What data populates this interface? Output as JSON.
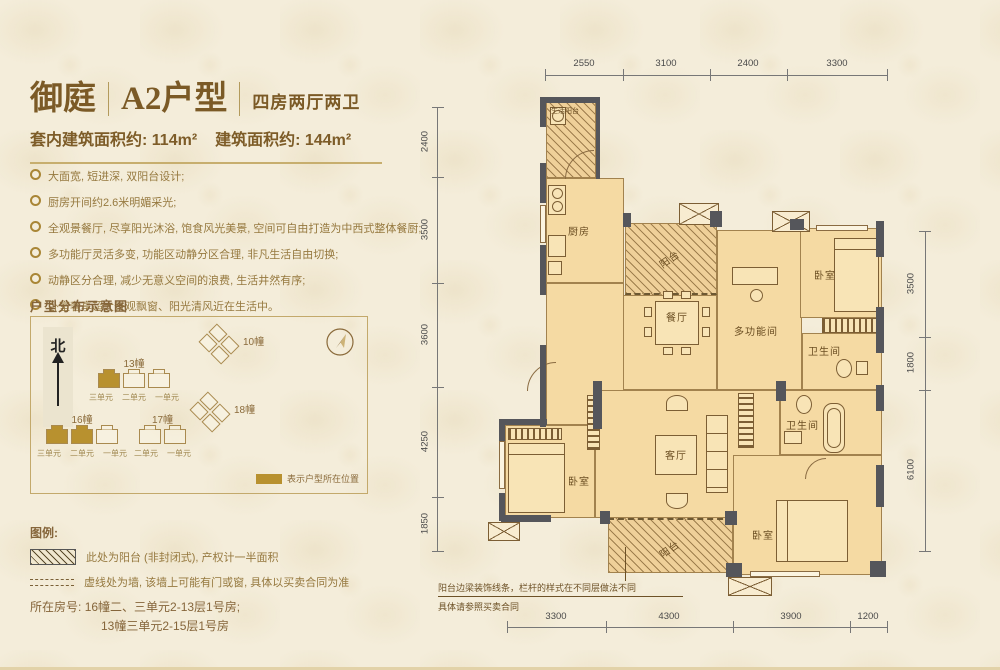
{
  "header": {
    "brand": "御庭",
    "unit_name": "A2户型",
    "layout_type": "四房两厅两卫",
    "inner_area": "套内建筑面积约: 114m²",
    "gross_area": "建筑面积约: 144m²"
  },
  "features": [
    "大面宽, 短进深, 双阳台设计;",
    "厨房开间约2.6米明媚采光;",
    "全观景餐厅, 尽享阳光沐浴, 饱食风光美景, 空间可自由打造为中西式整体餐厨;",
    "多功能厅灵活多变, 功能区动静分区合理, 非凡生活自由切换;",
    "动静区分合理, 减少无意义空间的浪费, 生活井然有序;",
    "卧室奢享超大景观飘窗、阳光清风近在生活中。"
  ],
  "site_map": {
    "title": "户型分布示意图",
    "north_label": "北",
    "buildings": [
      {
        "name": "13幢",
        "units": [
          "三单元",
          "二单元",
          "一单元"
        ],
        "wings": 3,
        "highlight": [
          0
        ],
        "rotated": false
      },
      {
        "name": "10幢",
        "units": [],
        "wings": 4,
        "highlight": [],
        "rotated": true
      },
      {
        "name": "16幢",
        "units": [
          "三单元",
          "二单元",
          "一单元"
        ],
        "wings": 3,
        "highlight": [
          0,
          1
        ],
        "rotated": false
      },
      {
        "name": "17幢",
        "units": [
          "二单元",
          "一单元"
        ],
        "wings": 2,
        "highlight": [],
        "rotated": false
      },
      {
        "name": "18幢",
        "units": [],
        "wings": 4,
        "highlight": [],
        "rotated": true
      }
    ],
    "key_note": "表示户型所在位置"
  },
  "legend": {
    "title": "图例:",
    "items": [
      {
        "swatch": "hatch",
        "text": "此处为阳台 (非封闭式), 产权计一半面积"
      },
      {
        "swatch": "dash",
        "text": "虚线处为墙, 该墙上可能有门或窗, 具体以买卖合同为准"
      }
    ]
  },
  "location": {
    "label": "所在房号:",
    "line1": "16幢二、三单元2-13层1号房;",
    "line2": "13幢三单元2-15层1号房"
  },
  "plan": {
    "rooms": {
      "service_balcony": "生活阳台",
      "kitchen": "厨房",
      "balcony_mid": "阳台",
      "dining": "餐厅",
      "multifunction": "多功能间",
      "bedroom_tr": "卧室",
      "bath_tr": "卫生间",
      "bath_r": "卫生间",
      "living": "客厅",
      "bedroom_bl": "卧室",
      "bedroom_br": "卧室",
      "balcony_bottom": "阳台"
    },
    "note_line1": "阳台边梁装饰线条，栏杆的样式在不同层做法不同",
    "note_line2": "具体请参照买卖合同",
    "dims": {
      "top": [
        {
          "label": "2550"
        },
        {
          "label": "3100"
        },
        {
          "label": "2400"
        },
        {
          "label": "3300"
        }
      ],
      "bottom": [
        {
          "label": "3300"
        },
        {
          "label": "4300"
        },
        {
          "label": "3900"
        },
        {
          "label": "1200"
        }
      ],
      "left": [
        {
          "label": "2400"
        },
        {
          "label": "3500"
        },
        {
          "label": "3600"
        },
        {
          "label": "4250"
        },
        {
          "label": "1850"
        }
      ],
      "right": [
        {
          "label": "3500"
        },
        {
          "label": "1800"
        },
        {
          "label": "6100"
        }
      ]
    }
  },
  "colors": {
    "accent_gold": "#b8912f",
    "wall": "#55565b",
    "room_fill": "#f5daa3",
    "text_gold": "#8a6a3a"
  }
}
